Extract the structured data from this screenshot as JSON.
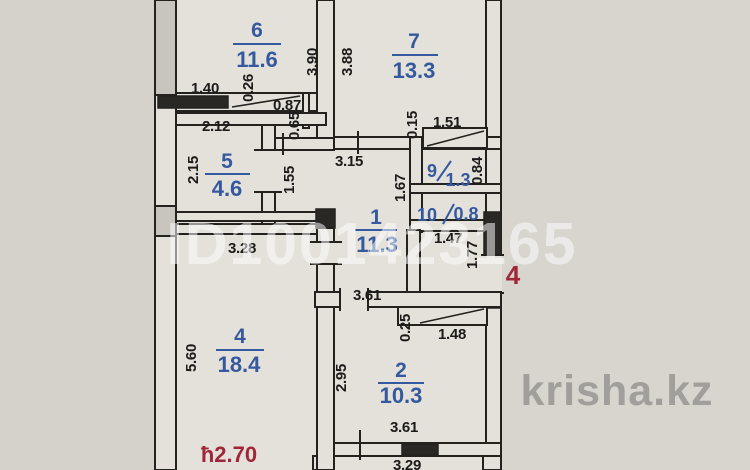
{
  "document_type": "apartment floor plan scan",
  "watermarks": {
    "listing_id": "ID1001423165",
    "site": "krisha.kz"
  },
  "notes": {
    "ceiling_height": "ħ2.70",
    "entrance_mark": "4"
  },
  "colors": {
    "background": "#d5d2cc",
    "paper": "#e4e1da",
    "wall_line": "#24221f",
    "wall_fill_dark": "#2a2824",
    "room_label_blue": "#34599f",
    "dimension_black": "#1c1b19",
    "red_accent": "#a0273a",
    "watermark_white": "#ffffff",
    "watermark_gray": "#9c9a96"
  },
  "rooms": {
    "r6": {
      "number": "6",
      "area": "11.6"
    },
    "r7": {
      "number": "7",
      "area": "13.3"
    },
    "r5": {
      "number": "5",
      "area": "4.6"
    },
    "r9": {
      "number": "9",
      "area": "1.3"
    },
    "r10": {
      "number": "10",
      "area": "0.8"
    },
    "r1": {
      "number": "1",
      "area": "11.3"
    },
    "r4": {
      "number": "4",
      "area": "18.4"
    },
    "r2": {
      "number": "2",
      "area": "10.3"
    }
  },
  "dims": {
    "d140": "1.40",
    "d026": "0.26",
    "d087": "0.87",
    "d065": "0.65",
    "d390": "3.90",
    "d388": "3.88",
    "d212": "2.12",
    "d215": "2.15",
    "d155": "1.55",
    "d315": "3.15",
    "d015": "0.15",
    "d151": "1.51",
    "d167": "1.67",
    "d084": "0.84",
    "d147": "1.47",
    "d177": "1.77",
    "d328": "3.28",
    "d560": "5.60",
    "d361a": "3.61",
    "d025": "0.25",
    "d148": "1.48",
    "d295": "2.95",
    "d361b": "3.61",
    "d329": "3.29"
  }
}
